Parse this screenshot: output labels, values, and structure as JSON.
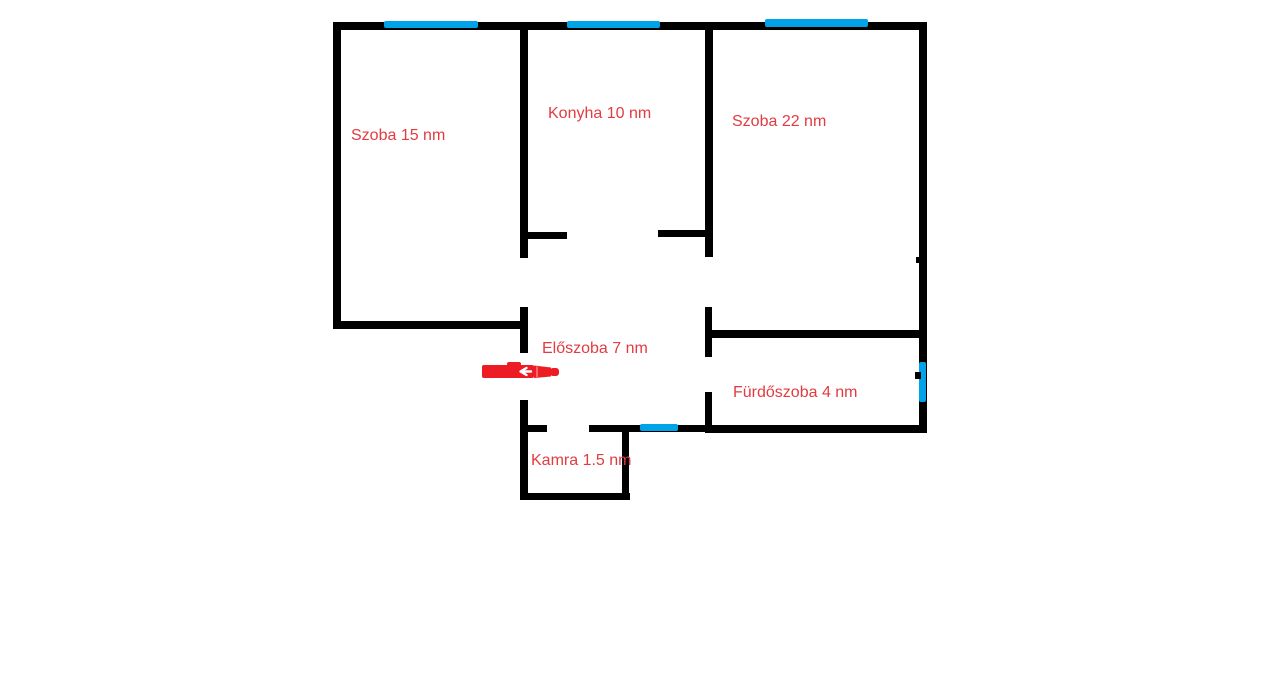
{
  "floorplan": {
    "canvas": {
      "width": 1280,
      "height": 677,
      "background_color": "#ffffff"
    },
    "colors": {
      "wall": "#000000",
      "window": "#00a2e8",
      "label": "#e23b40",
      "arrow": "#ed1c24",
      "arrow_chevron": "#ffffff"
    },
    "rooms": [
      {
        "name": "szoba-15",
        "label": "Szoba 15 nm",
        "area_nm": 15,
        "x": 351,
        "y": 127
      },
      {
        "name": "konyha",
        "label": "Konyha 10 nm",
        "area_nm": 10,
        "x": 548,
        "y": 105
      },
      {
        "name": "szoba-22",
        "label": "Szoba 22 nm",
        "area_nm": 22,
        "x": 732,
        "y": 113
      },
      {
        "name": "eloszoba",
        "label": "Előszoba 7 nm",
        "area_nm": 7,
        "x": 542,
        "y": 340
      },
      {
        "name": "furdoszoba",
        "label": "Fürdőszoba 4 nm",
        "area_nm": 4,
        "x": 733,
        "y": 384
      },
      {
        "name": "kamra",
        "label": "Kamra 1.5 nm",
        "area_nm": 1.5,
        "x": 531,
        "y": 452
      }
    ],
    "walls": [
      {
        "name": "wall-exterior-top",
        "x": 333,
        "y": 22,
        "w": 594,
        "h": 8
      },
      {
        "name": "wall-exterior-left",
        "x": 333,
        "y": 22,
        "w": 8,
        "h": 307
      },
      {
        "name": "wall-exterior-right",
        "x": 919,
        "y": 22,
        "w": 8,
        "h": 411
      },
      {
        "name": "wall-szoba15-konyha",
        "x": 520,
        "y": 22,
        "w": 8,
        "h": 236
      },
      {
        "name": "wall-konyha-szoba22",
        "x": 705,
        "y": 22,
        "w": 8,
        "h": 235
      },
      {
        "name": "wall-konyha-opening-left-stub",
        "x": 523,
        "y": 232,
        "w": 44,
        "h": 7
      },
      {
        "name": "wall-konyha-opening-right-stub",
        "x": 658,
        "y": 230,
        "w": 50,
        "h": 7
      },
      {
        "name": "wall-szoba15-bottom",
        "x": 333,
        "y": 321,
        "w": 194,
        "h": 8
      },
      {
        "name": "wall-eloszoba-left-upper",
        "x": 520,
        "y": 307,
        "w": 8,
        "h": 46
      },
      {
        "name": "wall-eloszoba-left-lower",
        "x": 520,
        "y": 400,
        "w": 8,
        "h": 100
      },
      {
        "name": "wall-kamra-top-stub",
        "x": 520,
        "y": 425,
        "w": 27,
        "h": 7
      },
      {
        "name": "wall-bottom-middle",
        "x": 589,
        "y": 425,
        "w": 123,
        "h": 7
      },
      {
        "name": "wall-kamra-right",
        "x": 622,
        "y": 428,
        "w": 7,
        "h": 72
      },
      {
        "name": "wall-kamra-bottom",
        "x": 520,
        "y": 493,
        "w": 110,
        "h": 7
      },
      {
        "name": "wall-szoba22-eloszoba",
        "x": 705,
        "y": 307,
        "w": 7,
        "h": 50
      },
      {
        "name": "wall-furdoszoba-left",
        "x": 705,
        "y": 392,
        "w": 7,
        "h": 41
      },
      {
        "name": "wall-furdoszoba-top",
        "x": 708,
        "y": 330,
        "w": 212,
        "h": 8
      },
      {
        "name": "wall-furdoszoba-bottom",
        "x": 705,
        "y": 425,
        "w": 222,
        "h": 8
      }
    ],
    "windows": [
      {
        "name": "window-szoba15-top",
        "x": 384,
        "y": 21,
        "w": 94,
        "h": 7
      },
      {
        "name": "window-konyha-top",
        "x": 567,
        "y": 21,
        "w": 93,
        "h": 7
      },
      {
        "name": "window-szoba22-top",
        "x": 765,
        "y": 19,
        "w": 103,
        "h": 8
      },
      {
        "name": "window-furdoszoba-right",
        "x": 919,
        "y": 362,
        "w": 7,
        "h": 40
      },
      {
        "name": "window-bottom-middle",
        "x": 640,
        "y": 424,
        "w": 38,
        "h": 7
      }
    ],
    "marks": [
      {
        "name": "wall-mark-right-upper",
        "x": 916,
        "y": 257,
        "w": 5,
        "h": 6
      },
      {
        "name": "wall-mark-right-lower",
        "x": 915,
        "y": 372,
        "w": 6,
        "h": 7
      }
    ],
    "entrance_arrow": {
      "name": "entrance-arrow",
      "x": 481,
      "y": 361,
      "w": 80,
      "h": 20,
      "direction": "right"
    }
  }
}
